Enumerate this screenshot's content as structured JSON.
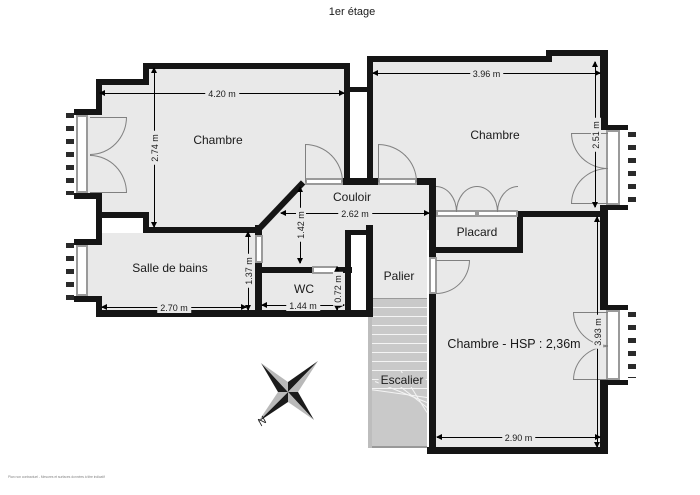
{
  "title": "1er étage",
  "rooms": {
    "chambre1": {
      "label": "Chambre",
      "width": "4.20 m",
      "height": "2.74 m"
    },
    "chambre2": {
      "label": "Chambre",
      "width": "3.96 m",
      "height": "2.51 m"
    },
    "couloir": {
      "label": "Couloir",
      "width": "2.62 m",
      "height": "1.42 m"
    },
    "placard": {
      "label": "Placard"
    },
    "sdb": {
      "label": "Salle de bains",
      "width": "2.70 m",
      "height": "1.37 m"
    },
    "wc": {
      "label": "WC",
      "width": "1.44 m",
      "height": "0.72 m"
    },
    "palier": {
      "label": "Palier"
    },
    "escalier": {
      "label": "Escalier"
    },
    "chambre3": {
      "label": "Chambre - HSP : 2,36m",
      "width": "2.90 m",
      "height": "3.93 m"
    }
  },
  "compass": {
    "north_label": "N"
  },
  "footer": {
    "note": "Plan non contractuel - Mesures et surfaces données à titre indicatif"
  },
  "colors": {
    "wall": "#151515",
    "floor": "#e9e9e9",
    "stair": "#c9c9c9",
    "door_line": "#808080",
    "window_frame": "#9a9a9a"
  }
}
